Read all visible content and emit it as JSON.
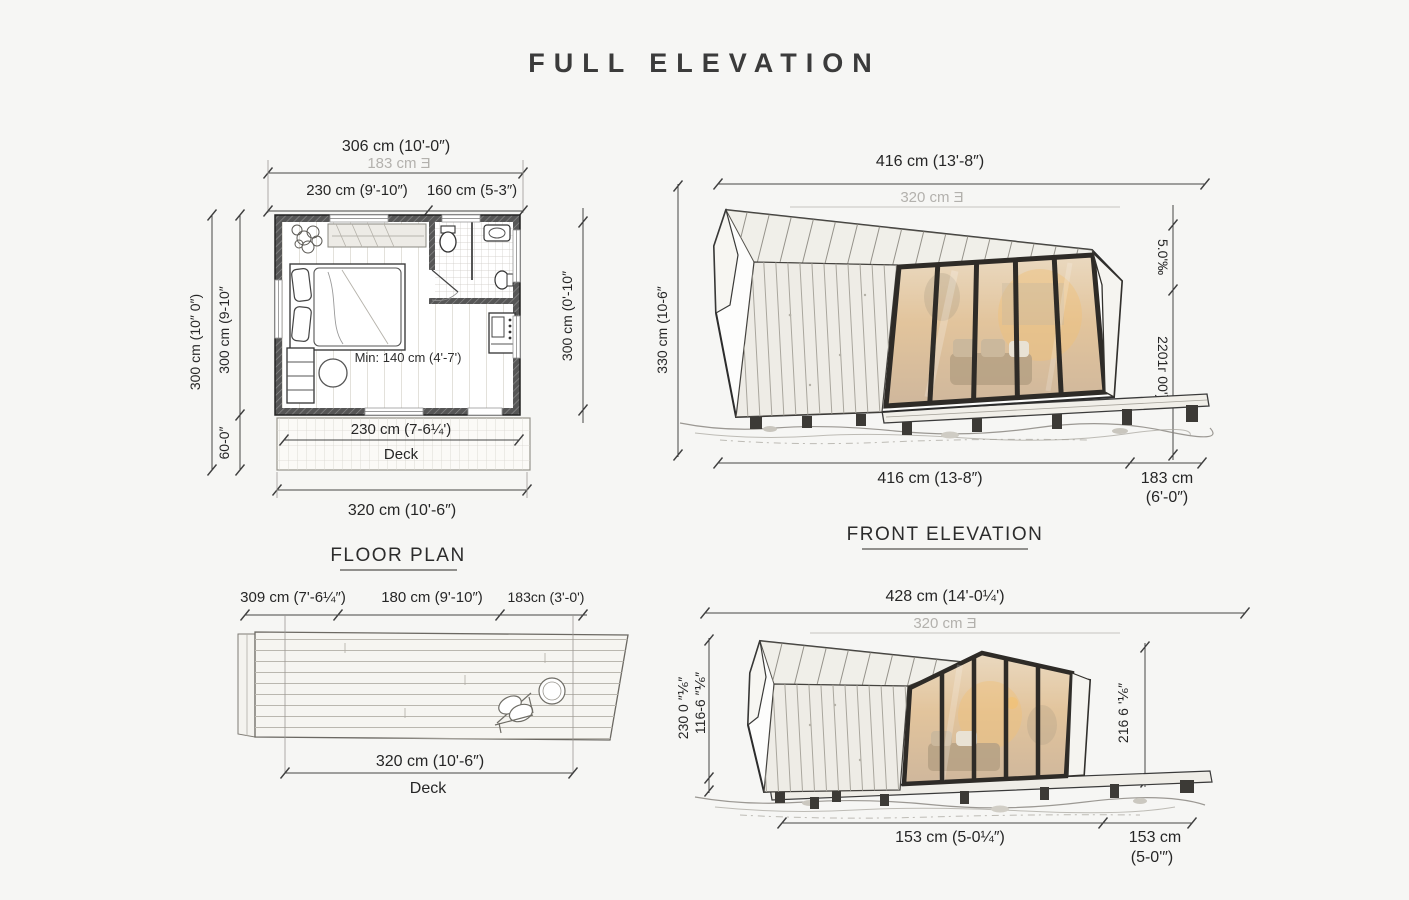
{
  "title": "FULL ELEVATION",
  "floor_plan": {
    "label": "FLOOR PLAN",
    "dim_top_total": "306 cm (10'-0″)",
    "dim_top_alt": "183 cm Ǝ",
    "dim_top_left": "230 cm (9'-10″)",
    "dim_top_right": "160 cm (5-3″)",
    "dim_left_outer": "300 cm (10″ 0″)",
    "dim_left_inner": "300 cm (9-10″",
    "dim_left_lower": "60-0″",
    "dim_right": "300 cm (0'-10″",
    "min_note": "Min: 140 cm (4'-7')",
    "dim_deck": "230 cm (7-6¼')",
    "deck_label": "Deck",
    "dim_bottom": "320 cm (10'-6″)"
  },
  "front_elevation": {
    "label": "FRONT ELEVATION",
    "dim_top_total": "416 cm (13'-8″)",
    "dim_top_alt": "320 cm Ǝ",
    "dim_left": "330 cm (10-6″",
    "dim_right_upper": "5.0'‰",
    "dim_right_lower": "2201г 00'))",
    "dim_bottom_main": "416 cm (13-8″)",
    "dim_bottom_right_1": "183 cm",
    "dim_bottom_right_2": "(6'-0″)"
  },
  "deck_plan": {
    "dim_top_left": "309 cm (7'-6¼″)",
    "dim_top_mid": "180 cm (9'-10″)",
    "dim_top_right": "183cn (3'-0')",
    "dim_bottom": "320 cm (10'-6″)",
    "deck_label": "Deck"
  },
  "side_elevation": {
    "dim_top_total": "428 cm (14'-0¼')",
    "dim_top_alt": "320 cm Ǝ",
    "dim_left_outer": "230 0 ″⅙″",
    "dim_left_inner": "116-6 ″⅙″",
    "dim_right": "216 6 '⅙″",
    "dim_bottom_main": "153 cm (5-0¼″)",
    "dim_bottom_right_1": "153 cm",
    "dim_bottom_right_2": "(5-0'″)"
  }
}
